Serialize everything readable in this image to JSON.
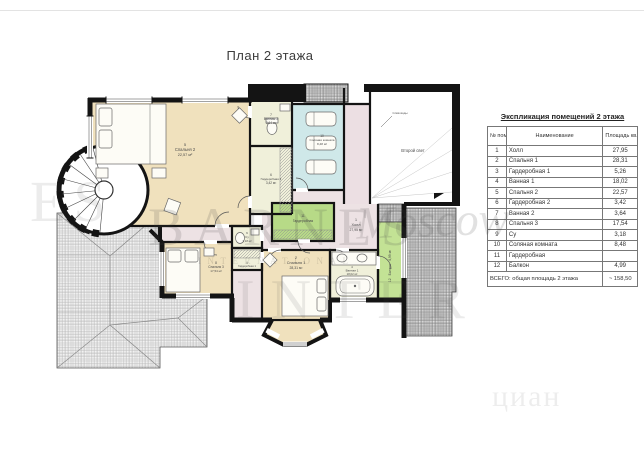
{
  "page": {
    "title": "План 2 этажа"
  },
  "plan": {
    "labels": {
      "hall": {
        "num": "1",
        "name": "Холл",
        "area": "27,95 м²"
      },
      "bedroom1": {
        "num": "2",
        "name": "Спальня 1",
        "area": "28,31 м²"
      },
      "wardrobe1": {
        "num": "3",
        "name": "Гардеробная 1",
        "area": "5,26 м²"
      },
      "bath1": {
        "num": "4",
        "name": "Ванная 1",
        "area": "18,02 м²"
      },
      "bedroom2": {
        "num": "5",
        "name": "Спальня 2",
        "area": "22,57 м²"
      },
      "wardrobe2": {
        "num": "6",
        "name": "Гардеробная 2",
        "area": "3,42 м²"
      },
      "bath2": {
        "num": "7",
        "name": "Ванная 2",
        "area": "3,64 м²"
      },
      "bedroom3": {
        "num": "8",
        "name": "Спальня 3",
        "area": "17,54 м²"
      },
      "su": {
        "num": "9",
        "name": "Су",
        "area": "3,18 м²"
      },
      "salt_room": {
        "num": "10",
        "name": "Соляная комната",
        "area": "8,48 м²"
      },
      "wardrobe": {
        "num": "11",
        "name": "Гардеробная",
        "area": ""
      },
      "balcony": {
        "num": "12",
        "name": "Балкон",
        "area": "4,99 м²"
      },
      "second_light": "Второй свет",
      "roof_note": "Слив воды"
    }
  },
  "table": {
    "title": "Экспликация помещений 2 этажа",
    "headers": {
      "num": "№ пом.",
      "name": "Наименование",
      "area": "Площадь кв.м."
    },
    "rows": [
      {
        "num": "1",
        "name": "Холл",
        "area": "27,95"
      },
      {
        "num": "2",
        "name": "Спальня 1",
        "area": "28,31"
      },
      {
        "num": "3",
        "name": "Гардеробная 1",
        "area": "5,26"
      },
      {
        "num": "4",
        "name": "Ванная 1",
        "area": "18,02"
      },
      {
        "num": "5",
        "name": "Спальня 2",
        "area": "22,57"
      },
      {
        "num": "6",
        "name": "Гардеробная 2",
        "area": "3,42"
      },
      {
        "num": "7",
        "name": "Ванная 2",
        "area": "3,64"
      },
      {
        "num": "8",
        "name": "Спальня 3",
        "area": "17,54"
      },
      {
        "num": "9",
        "name": "Су",
        "area": "3,18"
      },
      {
        "num": "10",
        "name": "Соляная комната",
        "area": "8,48"
      },
      {
        "num": "11",
        "name": "Гардеробная",
        "area": ""
      },
      {
        "num": "12",
        "name": "Балкон",
        "area": "4,99"
      }
    ],
    "total_label": "ВСЕГО: общая площадь 2 этажа",
    "total_value": "~ 158,50"
  },
  "watermark": {
    "brand": "BARNES",
    "city": "Moscow",
    "subtitle": "INTERNATIONAL",
    "fragment": "INTER",
    "edge_fragment": "ES",
    "site": "циан"
  },
  "colors": {
    "wall": "#141414",
    "bedroom_tan": "#f0e1bd",
    "bath_pale": "#f0f0da",
    "salt_room_blue": "#cfe8e9",
    "wardrobe_green": "#b7da87",
    "balcony_green": "#c3e295",
    "hall_pink": "#ede2e4",
    "roof_hatch_bg": "#f2f2f2"
  }
}
